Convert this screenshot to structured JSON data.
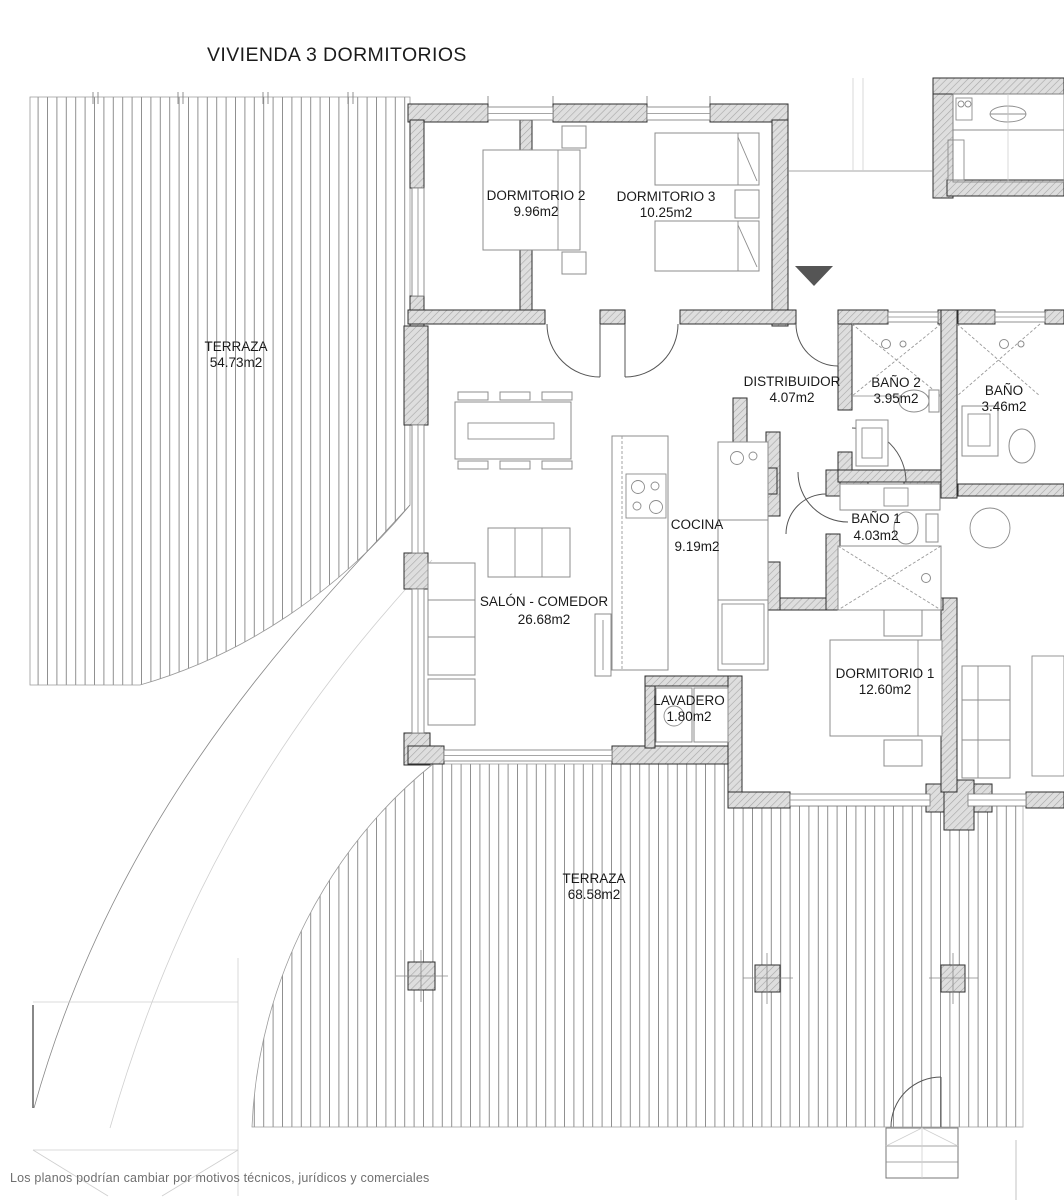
{
  "title": "VIVIENDA 3 DORMITORIOS",
  "disclaimer": "Los planos podrían cambiar por motivos técnicos, jurídicos y comerciales",
  "rooms": {
    "terraza_left": {
      "name": "TERRAZA",
      "area": "54.73m2"
    },
    "dormitorio2": {
      "name": "DORMITORIO 2",
      "area": "9.96m2"
    },
    "dormitorio3": {
      "name": "DORMITORIO 3",
      "area": "10.25m2"
    },
    "distribuidor": {
      "name": "DISTRIBUIDOR",
      "area": "4.07m2"
    },
    "bano2": {
      "name": "BAÑO 2",
      "area": "3.95m2"
    },
    "bano_adjacent": {
      "name": "BAÑO",
      "area": "3.46m2"
    },
    "cocina": {
      "name": "COCINA",
      "area": "9.19m2"
    },
    "bano1": {
      "name": "BAÑO 1",
      "area": "4.03m2"
    },
    "salon": {
      "name": "SALÓN - COMEDOR",
      "area": "26.68m2"
    },
    "lavadero": {
      "name": "LAVADERO",
      "area": "1.80m2"
    },
    "dormitorio1": {
      "name": "DORMITORIO 1",
      "area": "12.60m2"
    },
    "terraza_bottom": {
      "name": "TERRAZA",
      "area": "68.58m2"
    }
  },
  "colors": {
    "wall_fill": "#dedede",
    "wall_hatch": "#a6a6a6",
    "outline": "#2e2e2e",
    "deck_stripe": "#8f8f8f",
    "entry_marker": "#555555",
    "label_text": "#1a1a1a",
    "disclaimer_text": "#6f6f6f"
  }
}
